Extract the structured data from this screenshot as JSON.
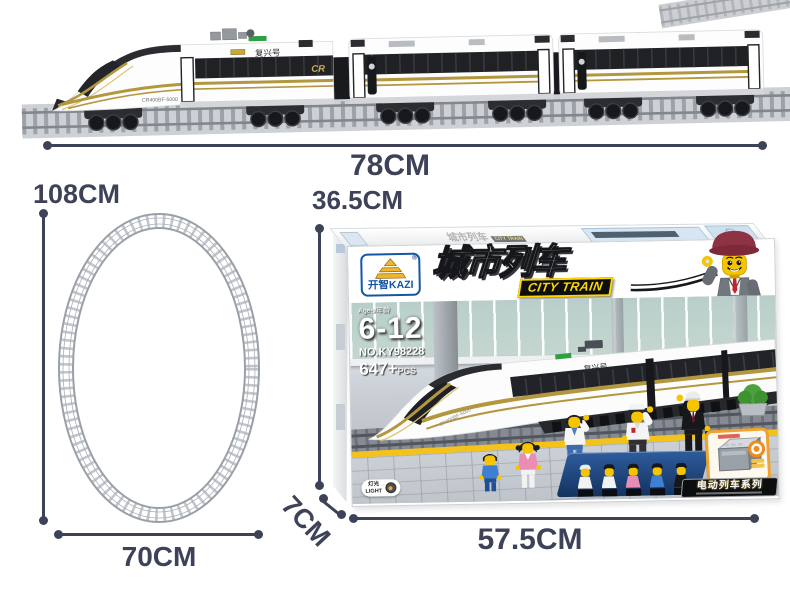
{
  "colors": {
    "dim": "#3d4259",
    "kazi_blue": "#1456a4",
    "gold": "#f0b62a",
    "badge_yellow": "#ffd800",
    "stripe_gold": "#b3973f",
    "platform_yellow": "#f3c21b"
  },
  "annotations": {
    "train_length": "78CM",
    "loop_height": "108CM",
    "loop_width": "70CM",
    "box_height": "36.5CM",
    "box_depth": "7CM",
    "box_width": "57.5CM"
  },
  "train_photo": {
    "roof_marking": "复兴号",
    "side_marking": "CR400BF-5000",
    "logo": "CR"
  },
  "box": {
    "brand_cn": "开智",
    "brand_en": "KAZI",
    "registered": "®",
    "title_cn": "城市列车",
    "title_en": "CITY TRAIN",
    "age_label": "Ages/年龄",
    "age_range": "6-12",
    "item_no": "NO.KY98228",
    "pieces": "647+",
    "pieces_unit": "PCS",
    "light_cn": "灯光",
    "light_en": "LIGHT",
    "series": "电动列车系列",
    "train_marking": "复兴号",
    "train_model": "CR400BF-5000"
  }
}
